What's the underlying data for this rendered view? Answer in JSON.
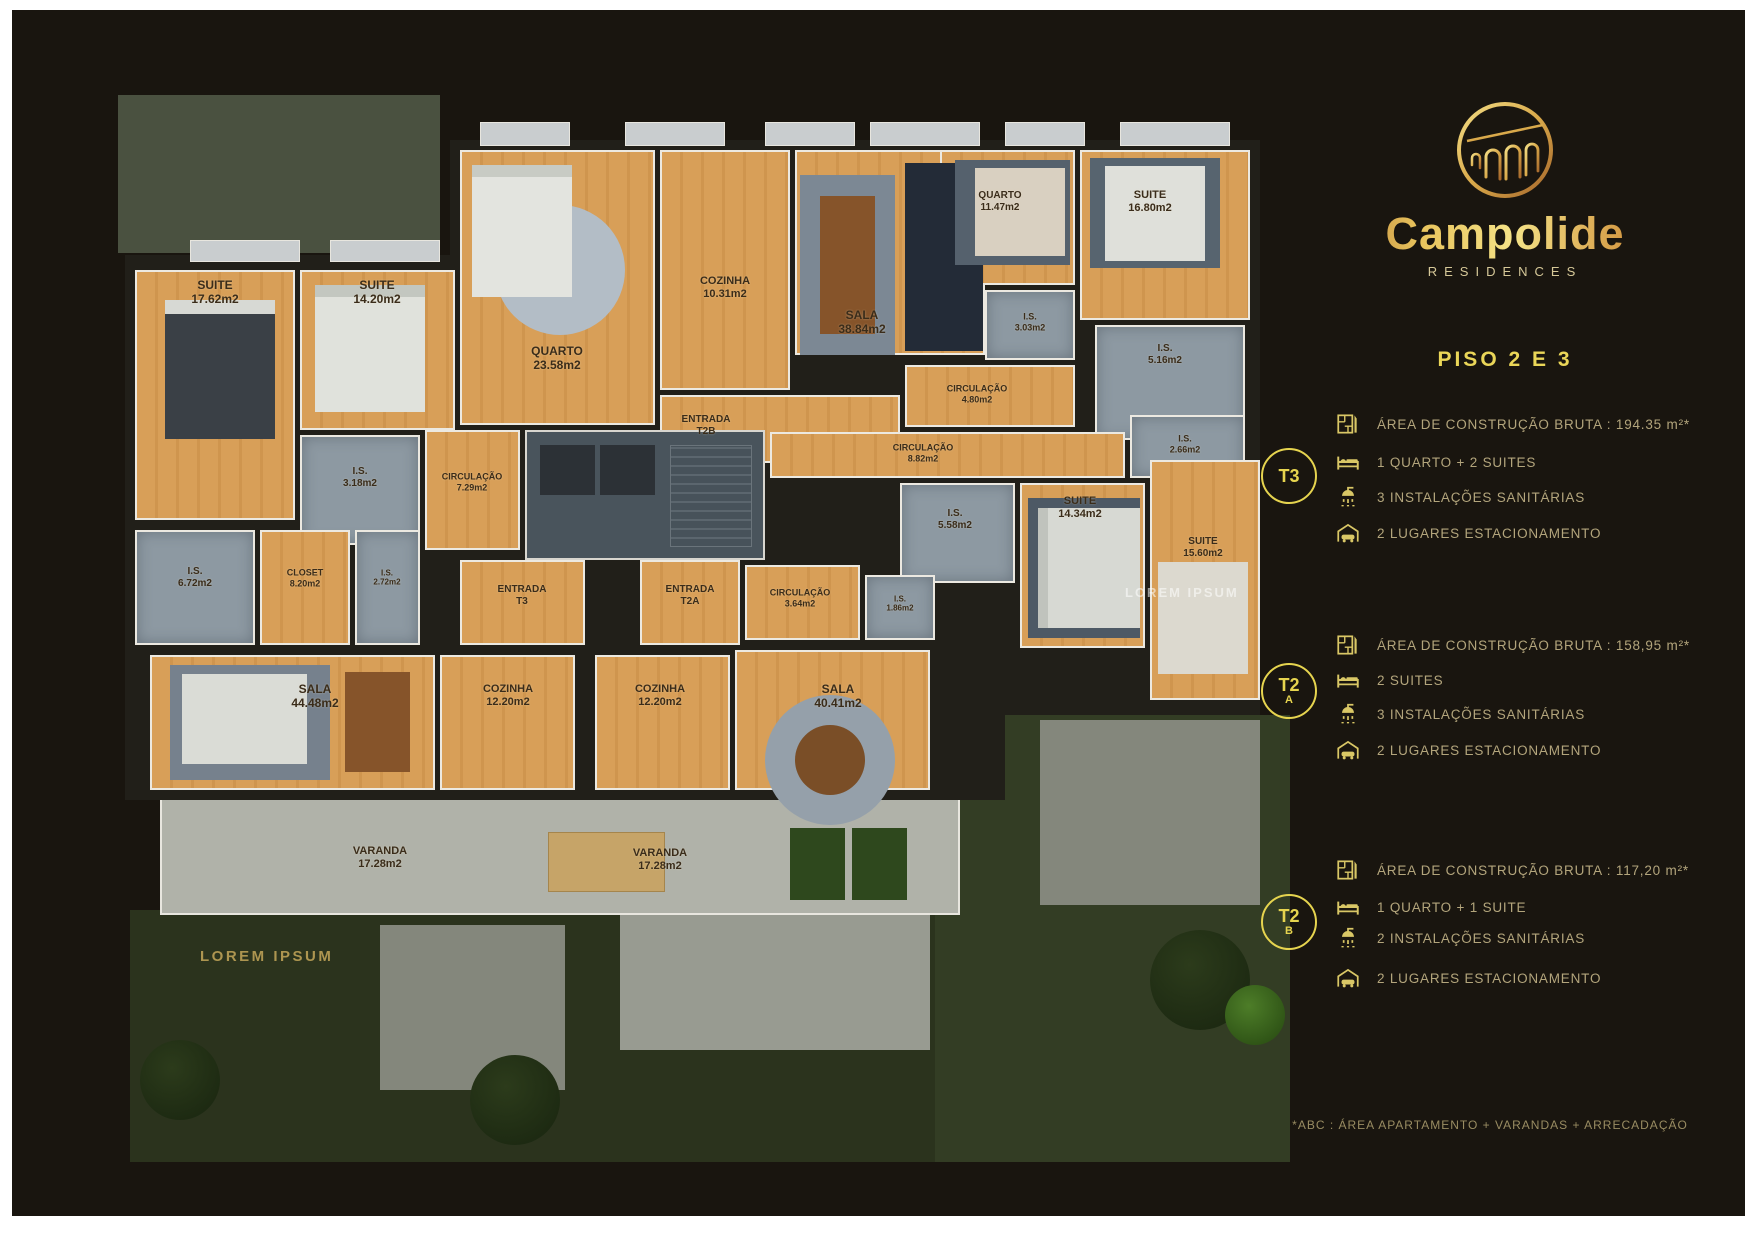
{
  "brand": {
    "name": "Campolide",
    "subtitle": "RESIDENCES"
  },
  "heading": "PISO 2 E 3",
  "units": [
    {
      "id": "T3",
      "badge_line1": "T3",
      "badge_line2": "",
      "specs": [
        {
          "icon": "floorplan-icon",
          "text": "ÁREA DE CONSTRUÇÃO BRUTA :  194.35 m²*"
        },
        {
          "icon": "bed-icon",
          "text": "1 QUARTO + 2 SUITES"
        },
        {
          "icon": "shower-icon",
          "text": "3 INSTALAÇÕES SANITÁRIAS"
        },
        {
          "icon": "car-icon",
          "text": "2 LUGARES ESTACIONAMENTO"
        }
      ]
    },
    {
      "id": "T2A",
      "badge_line1": "T2",
      "badge_line2": "A",
      "specs": [
        {
          "icon": "floorplan-icon",
          "text": "ÁREA DE CONSTRUÇÃO BRUTA :  158,95 m²*"
        },
        {
          "icon": "bed-icon",
          "text": "2 SUITES"
        },
        {
          "icon": "shower-icon",
          "text": "3 INSTALAÇÕES SANITÁRIAS"
        },
        {
          "icon": "car-icon",
          "text": "2 LUGARES ESTACIONAMENTO"
        }
      ]
    },
    {
      "id": "T2B",
      "badge_line1": "T2",
      "badge_line2": "B",
      "specs": [
        {
          "icon": "floorplan-icon",
          "text": "ÁREA DE CONSTRUÇÃO BRUTA :  117,20 m²*"
        },
        {
          "icon": "bed-icon",
          "text": "1 QUARTO + 1 SUITE"
        },
        {
          "icon": "shower-icon",
          "text": "2 INSTALAÇÕES SANITÁRIAS"
        },
        {
          "icon": "car-icon",
          "text": "2 LUGARES ESTACIONAMENTO"
        }
      ]
    }
  ],
  "footnote": "*ABC : ÁREA APARTAMENTO + VARANDAS + ARRECADAÇÃO",
  "colors": {
    "accent": "#e6d44f",
    "spec_text": "#b3a57c",
    "gold_dark": "#a4622a",
    "gold_light": "#f4e287",
    "wood": "#d89f58",
    "bath": "#8d99a2"
  },
  "floorplan": {
    "caption": "LOREM IPSUM",
    "watermark": "LOREM IPSUM",
    "rooms": [
      {
        "label": "SUITE",
        "area": "17.62m2",
        "type": "wood",
        "x": 135,
        "y": 270,
        "w": 160,
        "h": 250,
        "lx": 215,
        "ly": 292,
        "fs": 12
      },
      {
        "label": "SUITE",
        "area": "14.20m2",
        "type": "wood",
        "x": 300,
        "y": 270,
        "w": 155,
        "h": 160,
        "lx": 377,
        "ly": 292,
        "fs": 12
      },
      {
        "label": "I.S.",
        "area": "3.18m2",
        "type": "bath",
        "x": 300,
        "y": 435,
        "w": 120,
        "h": 110,
        "lx": 360,
        "ly": 478,
        "fs": 10
      },
      {
        "label": "CIRCULAÇÃO",
        "area": "7.29m2",
        "type": "wood",
        "x": 425,
        "y": 430,
        "w": 95,
        "h": 120,
        "lx": 472,
        "ly": 482,
        "fs": 9
      },
      {
        "label": "I.S.",
        "area": "6.72m2",
        "type": "bath",
        "x": 135,
        "y": 530,
        "w": 120,
        "h": 115,
        "lx": 195,
        "ly": 578,
        "fs": 10
      },
      {
        "label": "CLOSET",
        "area": "8.20m2",
        "type": "wood",
        "x": 260,
        "y": 530,
        "w": 90,
        "h": 115,
        "lx": 305,
        "ly": 578,
        "fs": 9
      },
      {
        "label": "I.S.",
        "area": "2.72m2",
        "type": "bath",
        "x": 355,
        "y": 530,
        "w": 65,
        "h": 115,
        "lx": 387,
        "ly": 578,
        "fs": 8
      },
      {
        "label": "QUARTO",
        "area": "23.58m2",
        "type": "wood",
        "x": 460,
        "y": 150,
        "w": 195,
        "h": 275,
        "lx": 557,
        "ly": 358,
        "fs": 12
      },
      {
        "label": "COZINHA",
        "area": "10.31m2",
        "type": "wood",
        "x": 660,
        "y": 150,
        "w": 130,
        "h": 240,
        "lx": 725,
        "ly": 288,
        "fs": 11
      },
      {
        "label": "SALA",
        "area": "38.84m2",
        "type": "wood",
        "x": 795,
        "y": 150,
        "w": 190,
        "h": 205,
        "lx": 862,
        "ly": 322,
        "fs": 12
      },
      {
        "label": "QUARTO",
        "area": "11.47m2",
        "type": "wood",
        "x": 940,
        "y": 150,
        "w": 135,
        "h": 135,
        "lx": 1000,
        "ly": 202,
        "fs": 10
      },
      {
        "label": "SUITE",
        "area": "16.80m2",
        "type": "wood",
        "x": 1080,
        "y": 150,
        "w": 170,
        "h": 170,
        "lx": 1150,
        "ly": 202,
        "fs": 11
      },
      {
        "label": "I.S.",
        "area": "3.03m2",
        "type": "bath",
        "x": 985,
        "y": 290,
        "w": 90,
        "h": 70,
        "lx": 1030,
        "ly": 322,
        "fs": 9
      },
      {
        "label": "I.S.",
        "area": "5.16m2",
        "type": "bath",
        "x": 1095,
        "y": 325,
        "w": 150,
        "h": 115,
        "lx": 1165,
        "ly": 355,
        "fs": 10
      },
      {
        "label": "CIRCULAÇÃO",
        "area": "4.80m2",
        "type": "wood",
        "x": 905,
        "y": 365,
        "w": 170,
        "h": 62,
        "lx": 977,
        "ly": 394,
        "fs": 9
      },
      {
        "label": "ENTRADA",
        "area": "T2B",
        "type": "wood",
        "x": 660,
        "y": 395,
        "w": 240,
        "h": 68,
        "lx": 706,
        "ly": 426,
        "fs": 10
      },
      {
        "label": "CIRCULAÇÃO",
        "area": "8.82m2",
        "type": "wood",
        "x": 770,
        "y": 432,
        "w": 355,
        "h": 46,
        "lx": 923,
        "ly": 453,
        "fs": 9
      },
      {
        "label": "I.S.",
        "area": "2.66m2",
        "type": "bath",
        "x": 1130,
        "y": 415,
        "w": 115,
        "h": 63,
        "lx": 1185,
        "ly": 444,
        "fs": 9
      },
      {
        "label": "I.S.",
        "area": "5.58m2",
        "type": "bath",
        "x": 900,
        "y": 483,
        "w": 115,
        "h": 100,
        "lx": 955,
        "ly": 520,
        "fs": 10
      },
      {
        "label": "SUITE",
        "area": "14.34m2",
        "type": "wood",
        "x": 1020,
        "y": 483,
        "w": 125,
        "h": 165,
        "lx": 1080,
        "ly": 508,
        "fs": 11
      },
      {
        "label": "SUITE",
        "area": "15.60m2",
        "type": "wood",
        "x": 1150,
        "y": 460,
        "w": 110,
        "h": 240,
        "lx": 1203,
        "ly": 548,
        "fs": 10
      },
      {
        "label": "ENTRADA",
        "area": "T3",
        "type": "wood",
        "x": 460,
        "y": 560,
        "w": 125,
        "h": 85,
        "lx": 522,
        "ly": 596,
        "fs": 10
      },
      {
        "label": "ENTRADA",
        "area": "T2A",
        "type": "wood",
        "x": 640,
        "y": 560,
        "w": 100,
        "h": 85,
        "lx": 690,
        "ly": 596,
        "fs": 10
      },
      {
        "label": "CIRCULAÇÃO",
        "area": "3.64m2",
        "type": "wood",
        "x": 745,
        "y": 565,
        "w": 115,
        "h": 75,
        "lx": 800,
        "ly": 598,
        "fs": 9
      },
      {
        "label": "I.S.",
        "area": "1.86m2",
        "type": "bath",
        "x": 865,
        "y": 575,
        "w": 70,
        "h": 65,
        "lx": 900,
        "ly": 604,
        "fs": 8
      },
      {
        "label": "SALA",
        "area": "44.48m2",
        "type": "wood",
        "x": 150,
        "y": 655,
        "w": 285,
        "h": 135,
        "lx": 315,
        "ly": 696,
        "fs": 12
      },
      {
        "label": "COZINHA",
        "area": "12.20m2",
        "type": "wood",
        "x": 440,
        "y": 655,
        "w": 135,
        "h": 135,
        "lx": 508,
        "ly": 696,
        "fs": 11
      },
      {
        "label": "COZINHA",
        "area": "12.20m2",
        "type": "wood",
        "x": 595,
        "y": 655,
        "w": 135,
        "h": 135,
        "lx": 660,
        "ly": 696,
        "fs": 11
      },
      {
        "label": "SALA",
        "area": "40.41m2",
        "type": "wood",
        "x": 735,
        "y": 650,
        "w": 195,
        "h": 140,
        "lx": 838,
        "ly": 696,
        "fs": 12
      },
      {
        "label": "VARANDA",
        "area": "17.28m2",
        "type": "none",
        "x": 0,
        "y": 0,
        "w": 0,
        "h": 0,
        "lx": 380,
        "ly": 858,
        "fs": 11
      },
      {
        "label": "VARANDA",
        "area": "17.28m2",
        "type": "none",
        "x": 0,
        "y": 0,
        "w": 0,
        "h": 0,
        "lx": 660,
        "ly": 860,
        "fs": 11
      }
    ]
  }
}
